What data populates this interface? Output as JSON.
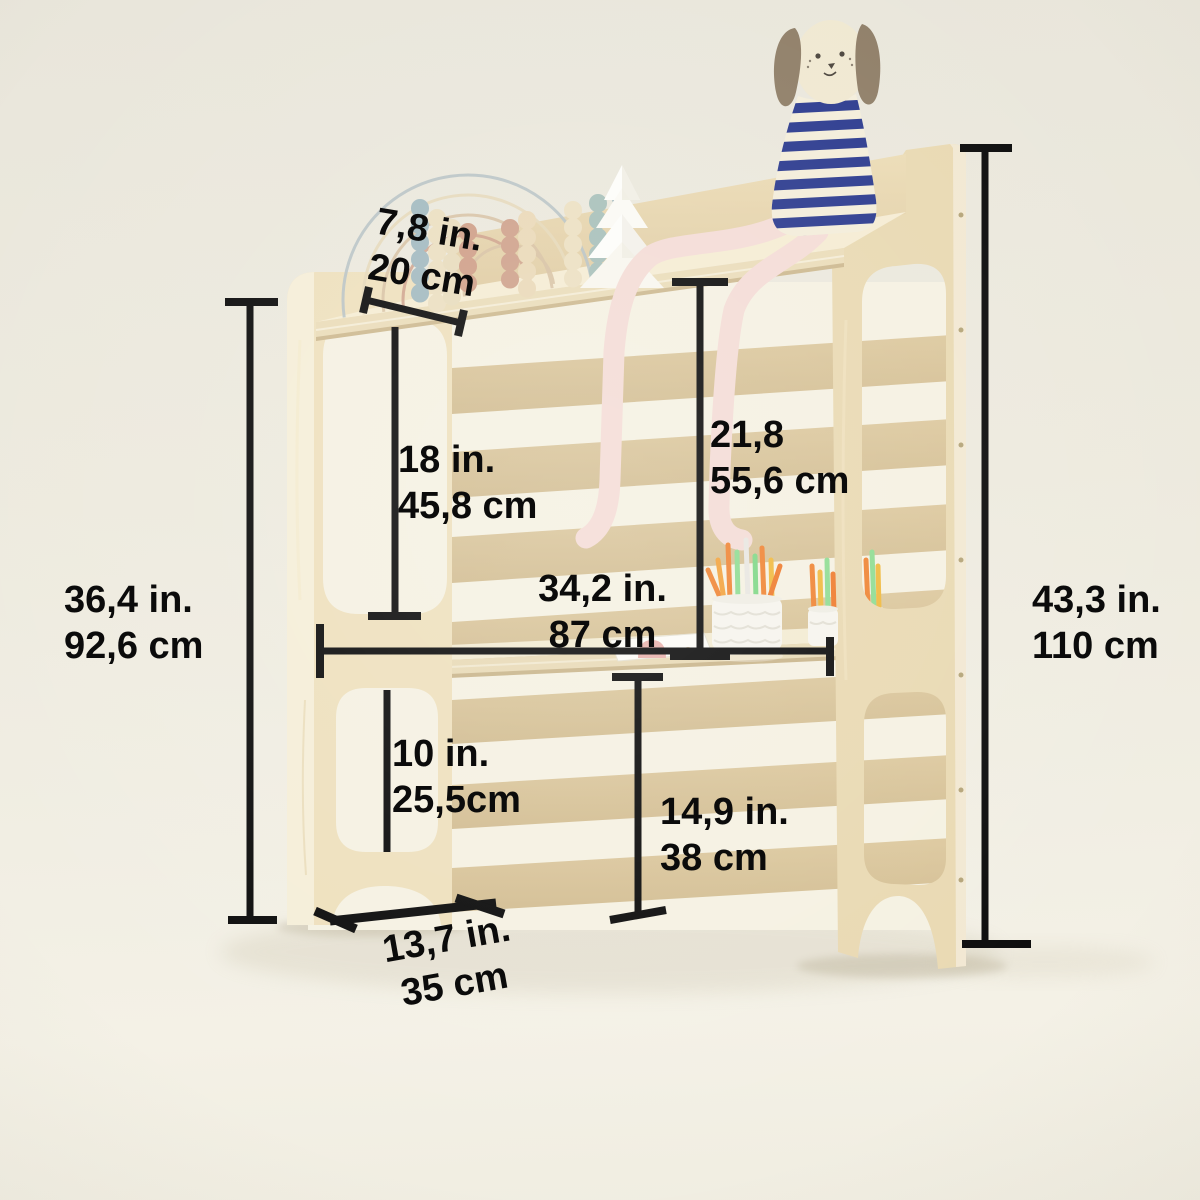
{
  "measurements": {
    "top_shelf_depth": {
      "inches": "7,8 in.",
      "cm": "20 cm"
    },
    "upper_opening_height": {
      "inches": "18 in.",
      "cm": "45,8 cm"
    },
    "desk_to_top_height": {
      "inches": "21,8",
      "cm": "55,6 cm"
    },
    "side_panel_height": {
      "inches": "36,4 in.",
      "cm": "92,6 cm"
    },
    "width": {
      "inches": "34,2 in.",
      "cm": "87 cm"
    },
    "total_height": {
      "inches": "43,3 in.",
      "cm": "110 cm"
    },
    "lower_opening_height": {
      "inches": "10 in.",
      "cm": "25,5cm"
    },
    "desk_surface_height": {
      "inches": "14,9 in.",
      "cm": "38 cm"
    },
    "base_depth": {
      "inches": "13,7 in.",
      "cm": "35 cm"
    }
  },
  "colors": {
    "dimension_line": "#0b0b0b",
    "label_text": "#0b0b0b",
    "wall": "#eceadf",
    "floor": "#f3f0e5",
    "wood_face": "#eee0bd",
    "wood_edge": "#f5eed8",
    "wood_slat": "#d9c59b",
    "dog_shirt_navy": "#2b3a8e",
    "dog_ear_taupe": "#8f7e67",
    "plush_leg_pink": "#f4dcd6",
    "pencil_orange": "#ef8433",
    "pencil_green": "#8fdc92",
    "pencil_yellow": "#f0b93e"
  }
}
